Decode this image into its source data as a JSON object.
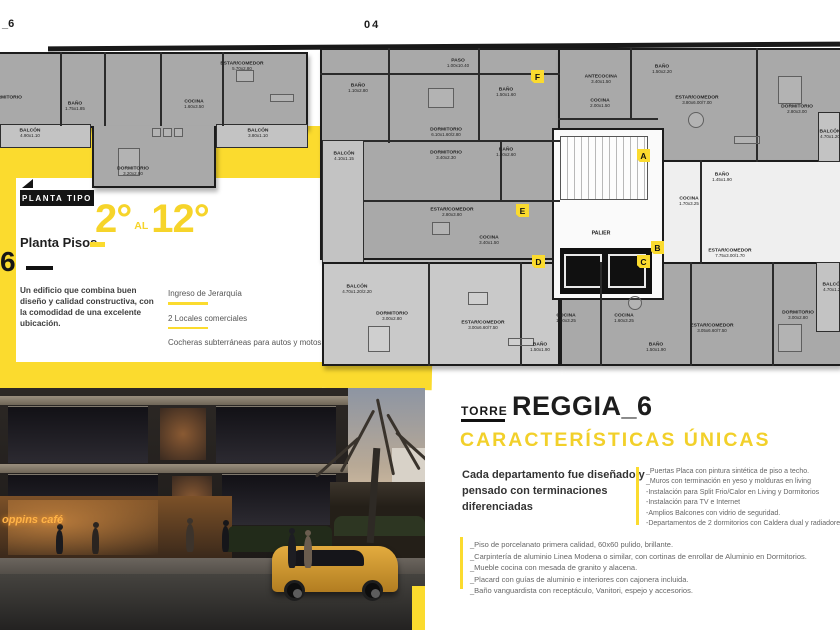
{
  "page": {
    "top_left_code": "_6",
    "top_page_number": "04",
    "side_number": "6",
    "side_dash": ""
  },
  "colors": {
    "yellow": "#FBDB2E",
    "plan_dark": "#A9A9A9",
    "plan_light": "#C9C9C9"
  },
  "plan": {
    "tag": "PLANTA TIPO",
    "floors_label": "Planta Pisos",
    "floors_from": "2°",
    "floors_al": "AL",
    "floors_to": "12°",
    "description": "Un edificio que combina buen diseño y calidad constructiva, con la comodidad de una excelente ubicación.",
    "features": [
      "Ingreso de Jerarquía",
      "2 Locales comerciales",
      "Cocheras subterráneas para autos y motos"
    ],
    "palier_label": "PALIER",
    "markers": [
      {
        "letter": "F",
        "x": 531,
        "y": 70
      },
      {
        "letter": "A",
        "x": 637,
        "y": 149
      },
      {
        "letter": "E",
        "x": 516,
        "y": 204
      },
      {
        "letter": "B",
        "x": 651,
        "y": 241
      },
      {
        "letter": "D",
        "x": 532,
        "y": 255
      },
      {
        "letter": "C",
        "x": 637,
        "y": 255
      }
    ],
    "rooms": [
      {
        "name": "DORMITORIO",
        "dims": "",
        "x": 6,
        "y": 95
      },
      {
        "name": "BAÑO",
        "dims": "1.75x1.85",
        "x": 75,
        "y": 101
      },
      {
        "name": "COCINA",
        "dims": "1.60x3.50",
        "x": 194,
        "y": 99
      },
      {
        "name": "ESTAR/COMEDOR",
        "dims": "5.70x2.80",
        "x": 242,
        "y": 61
      },
      {
        "name": "BALCÓN",
        "dims": "4.90x1.10",
        "x": 30,
        "y": 128
      },
      {
        "name": "DORMITORIO",
        "dims": "3.20x2.80",
        "x": 133,
        "y": 166
      },
      {
        "name": "BALCÓN",
        "dims": "3.80x1.10",
        "x": 258,
        "y": 128
      },
      {
        "name": "PASO",
        "dims": "1.00x10.40",
        "x": 458,
        "y": 58
      },
      {
        "name": "BAÑO",
        "dims": "1.10x2.80",
        "x": 358,
        "y": 83
      },
      {
        "name": "DORMITORIO",
        "dims": "6.10x1.60/2.80",
        "x": 446,
        "y": 127
      },
      {
        "name": "DORMITORIO",
        "dims": "3.40x2.30",
        "x": 446,
        "y": 150
      },
      {
        "name": "BALCÓN",
        "dims": "4.10x1.15",
        "x": 344,
        "y": 151
      },
      {
        "name": "BAÑO",
        "dims": "1.50x1.60",
        "x": 506,
        "y": 87
      },
      {
        "name": "BAÑO",
        "dims": "1.50x2.60",
        "x": 506,
        "y": 147
      },
      {
        "name": "ESTAR/COMEDOR",
        "dims": "2.80x3.80",
        "x": 452,
        "y": 207
      },
      {
        "name": "COCINA",
        "dims": "3.40x1.50",
        "x": 489,
        "y": 235
      },
      {
        "name": "ANTECOCINA",
        "dims": "3.40x1.50",
        "x": 601,
        "y": 74
      },
      {
        "name": "COCINA",
        "dims": "2.00x1.50",
        "x": 600,
        "y": 98
      },
      {
        "name": "BAÑO",
        "dims": "1.50x2.20",
        "x": 662,
        "y": 64
      },
      {
        "name": "ESTAR/COMEDOR",
        "dims": "3.80x6.00/7.00",
        "x": 697,
        "y": 95
      },
      {
        "name": "DORMITORIO",
        "dims": "2.80x3.00",
        "x": 797,
        "y": 104
      },
      {
        "name": "BALCÓN",
        "dims": "4.70x1.20",
        "x": 830,
        "y": 129
      },
      {
        "name": "BAÑO",
        "dims": "1.45x1.90",
        "x": 722,
        "y": 172
      },
      {
        "name": "COCINA",
        "dims": "1.70x3.25",
        "x": 689,
        "y": 196
      },
      {
        "name": "ESTAR/COMEDOR",
        "dims": "7.75x3.00/1.70",
        "x": 730,
        "y": 248
      },
      {
        "name": "BALCÓN",
        "dims": "4.70x1.20/2.20",
        "x": 357,
        "y": 284
      },
      {
        "name": "DORMITORIO",
        "dims": "3.00x2.80",
        "x": 392,
        "y": 311
      },
      {
        "name": "ESTAR/COMEDOR",
        "dims": "3.00x6.60/7.50",
        "x": 483,
        "y": 320
      },
      {
        "name": "COCINA",
        "dims": "1.60x3.25",
        "x": 566,
        "y": 313
      },
      {
        "name": "BAÑO",
        "dims": "1.50x1.90",
        "x": 540,
        "y": 342
      },
      {
        "name": "COCINA",
        "dims": "1.60x3.25",
        "x": 624,
        "y": 313
      },
      {
        "name": "BAÑO",
        "dims": "1.50x1.90",
        "x": 656,
        "y": 342
      },
      {
        "name": "ESTAR/COMEDOR",
        "dims": "3.05x6.60/7.50",
        "x": 712,
        "y": 323
      },
      {
        "name": "DORMITORIO",
        "dims": "3.00x2.80",
        "x": 798,
        "y": 310
      },
      {
        "name": "BALCÓN",
        "dims": "4.70x1.20",
        "x": 833,
        "y": 282
      }
    ]
  },
  "torre": {
    "kicker": "TORRE",
    "name": "REGGIA_6",
    "headline": "CARACTERÍSTICAS ÚNICAS",
    "intro": "Cada departamento fue diseñado y pensado con terminaciones diferenciadas",
    "features_right": [
      "_Puertas Placa con pintura sintética de piso a techo.",
      "_Muros con terminación en yeso y molduras en living",
      "-Instalación para Split Frio/Calor en Living y Dormitorios",
      "-Instalación para TV e Internet",
      "-Amplios Balcones con vidrio de seguridad.",
      "-Departamentos de 2 dormitorios con Caldera dual y radiadores"
    ],
    "features_bottom": [
      "_Piso de porcelanato primera calidad, 60x60 pulido, brillante.",
      "_Carpintería de aluminio Linea Modena o similar, con cortinas de enrollar de Aluminio en Dormitorios.",
      "_Mueble cocina con mesada de granito y alacena.",
      "_Placard con guías de aluminio e interiores con cajonera incluida.",
      "_Baño vanguardista con receptáculo, Vanitori, espejo y accesorios."
    ]
  },
  "photo": {
    "cafe_sign": "oppins café"
  }
}
